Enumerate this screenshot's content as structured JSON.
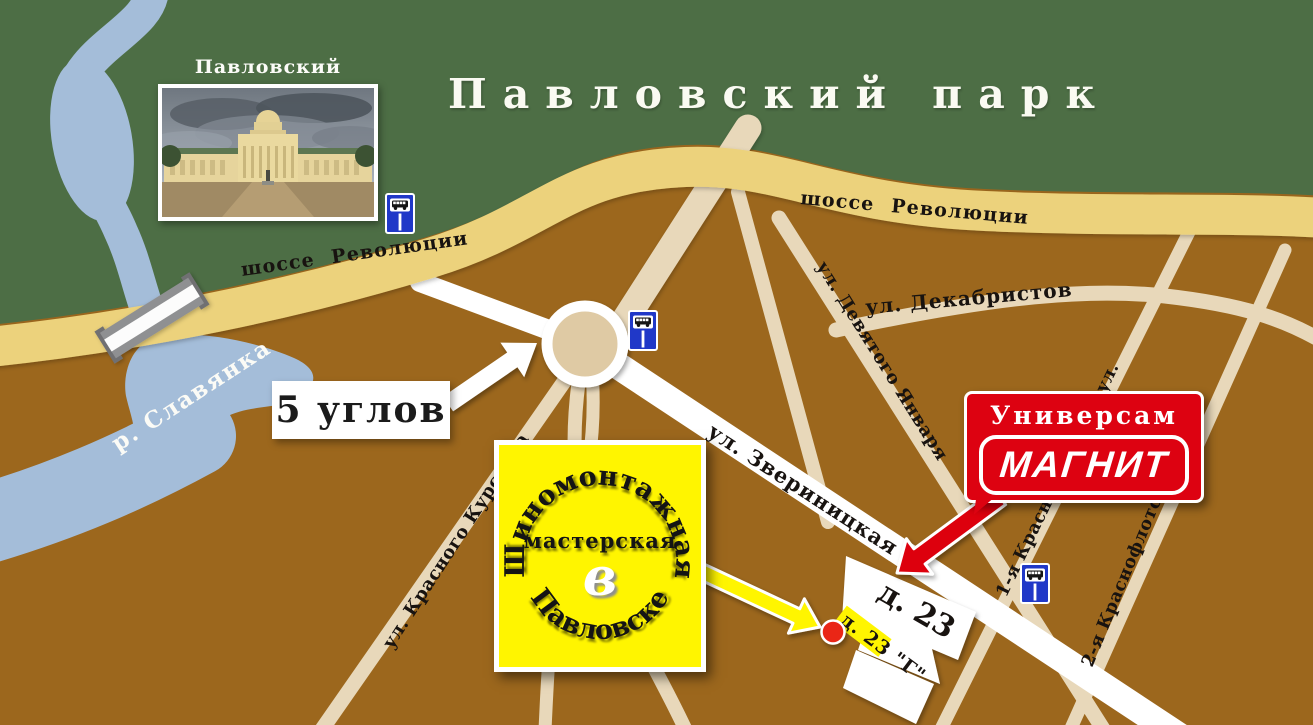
{
  "title": {
    "park": "Павловский парк"
  },
  "palace": {
    "caption": "Павловский дворец"
  },
  "labels": {
    "river": "р. Славянка",
    "highway": "шоссе Революции",
    "five_corners": "5 углов",
    "house23": "д. 23",
    "house23g": "д. 23 \"Г\""
  },
  "streets": {
    "zverinitskaya": "ул. Звериницкая",
    "krasnogo_kursanta": "ул. Красного Курсанта",
    "devyatogo_yanvarya": "ул. Девятого Января",
    "dekabristov": "ул. Декабристов",
    "krasnoflotskaya1": "1-я Краснофлотская ул.",
    "krasnoflotskaya2": "2-я Краснофлотская ул."
  },
  "magnit_sign": {
    "line1": "Универсам",
    "logo": "МАГНИТ"
  },
  "shop_sign": {
    "arc_top": "Шиномонтажная",
    "middle": "мастерская",
    "preposition": "в",
    "arc_bottom": "Павловске"
  },
  "icons": {
    "bus_stop": "bus-stop-icon",
    "location_dot": "location-marker-icon",
    "arrow_white": "direction-arrow-icon",
    "arrow_red": "magnit-pointer-arrow-icon",
    "arrow_yellow": "shop-pointer-arrow-icon"
  },
  "colors": {
    "ground": "#9c671d",
    "park": "#4d6e45",
    "river": "#a4bdd9",
    "highway": "#ecd27b",
    "road_minor": "#e8d8ba",
    "road_major": "#ffffff",
    "roundabout": "#dfcaa4",
    "sign_yellow": "#fff500",
    "magnit_red": "#dd0211",
    "bus_blue": "#2038c8",
    "marker_red": "#ea2517"
  }
}
